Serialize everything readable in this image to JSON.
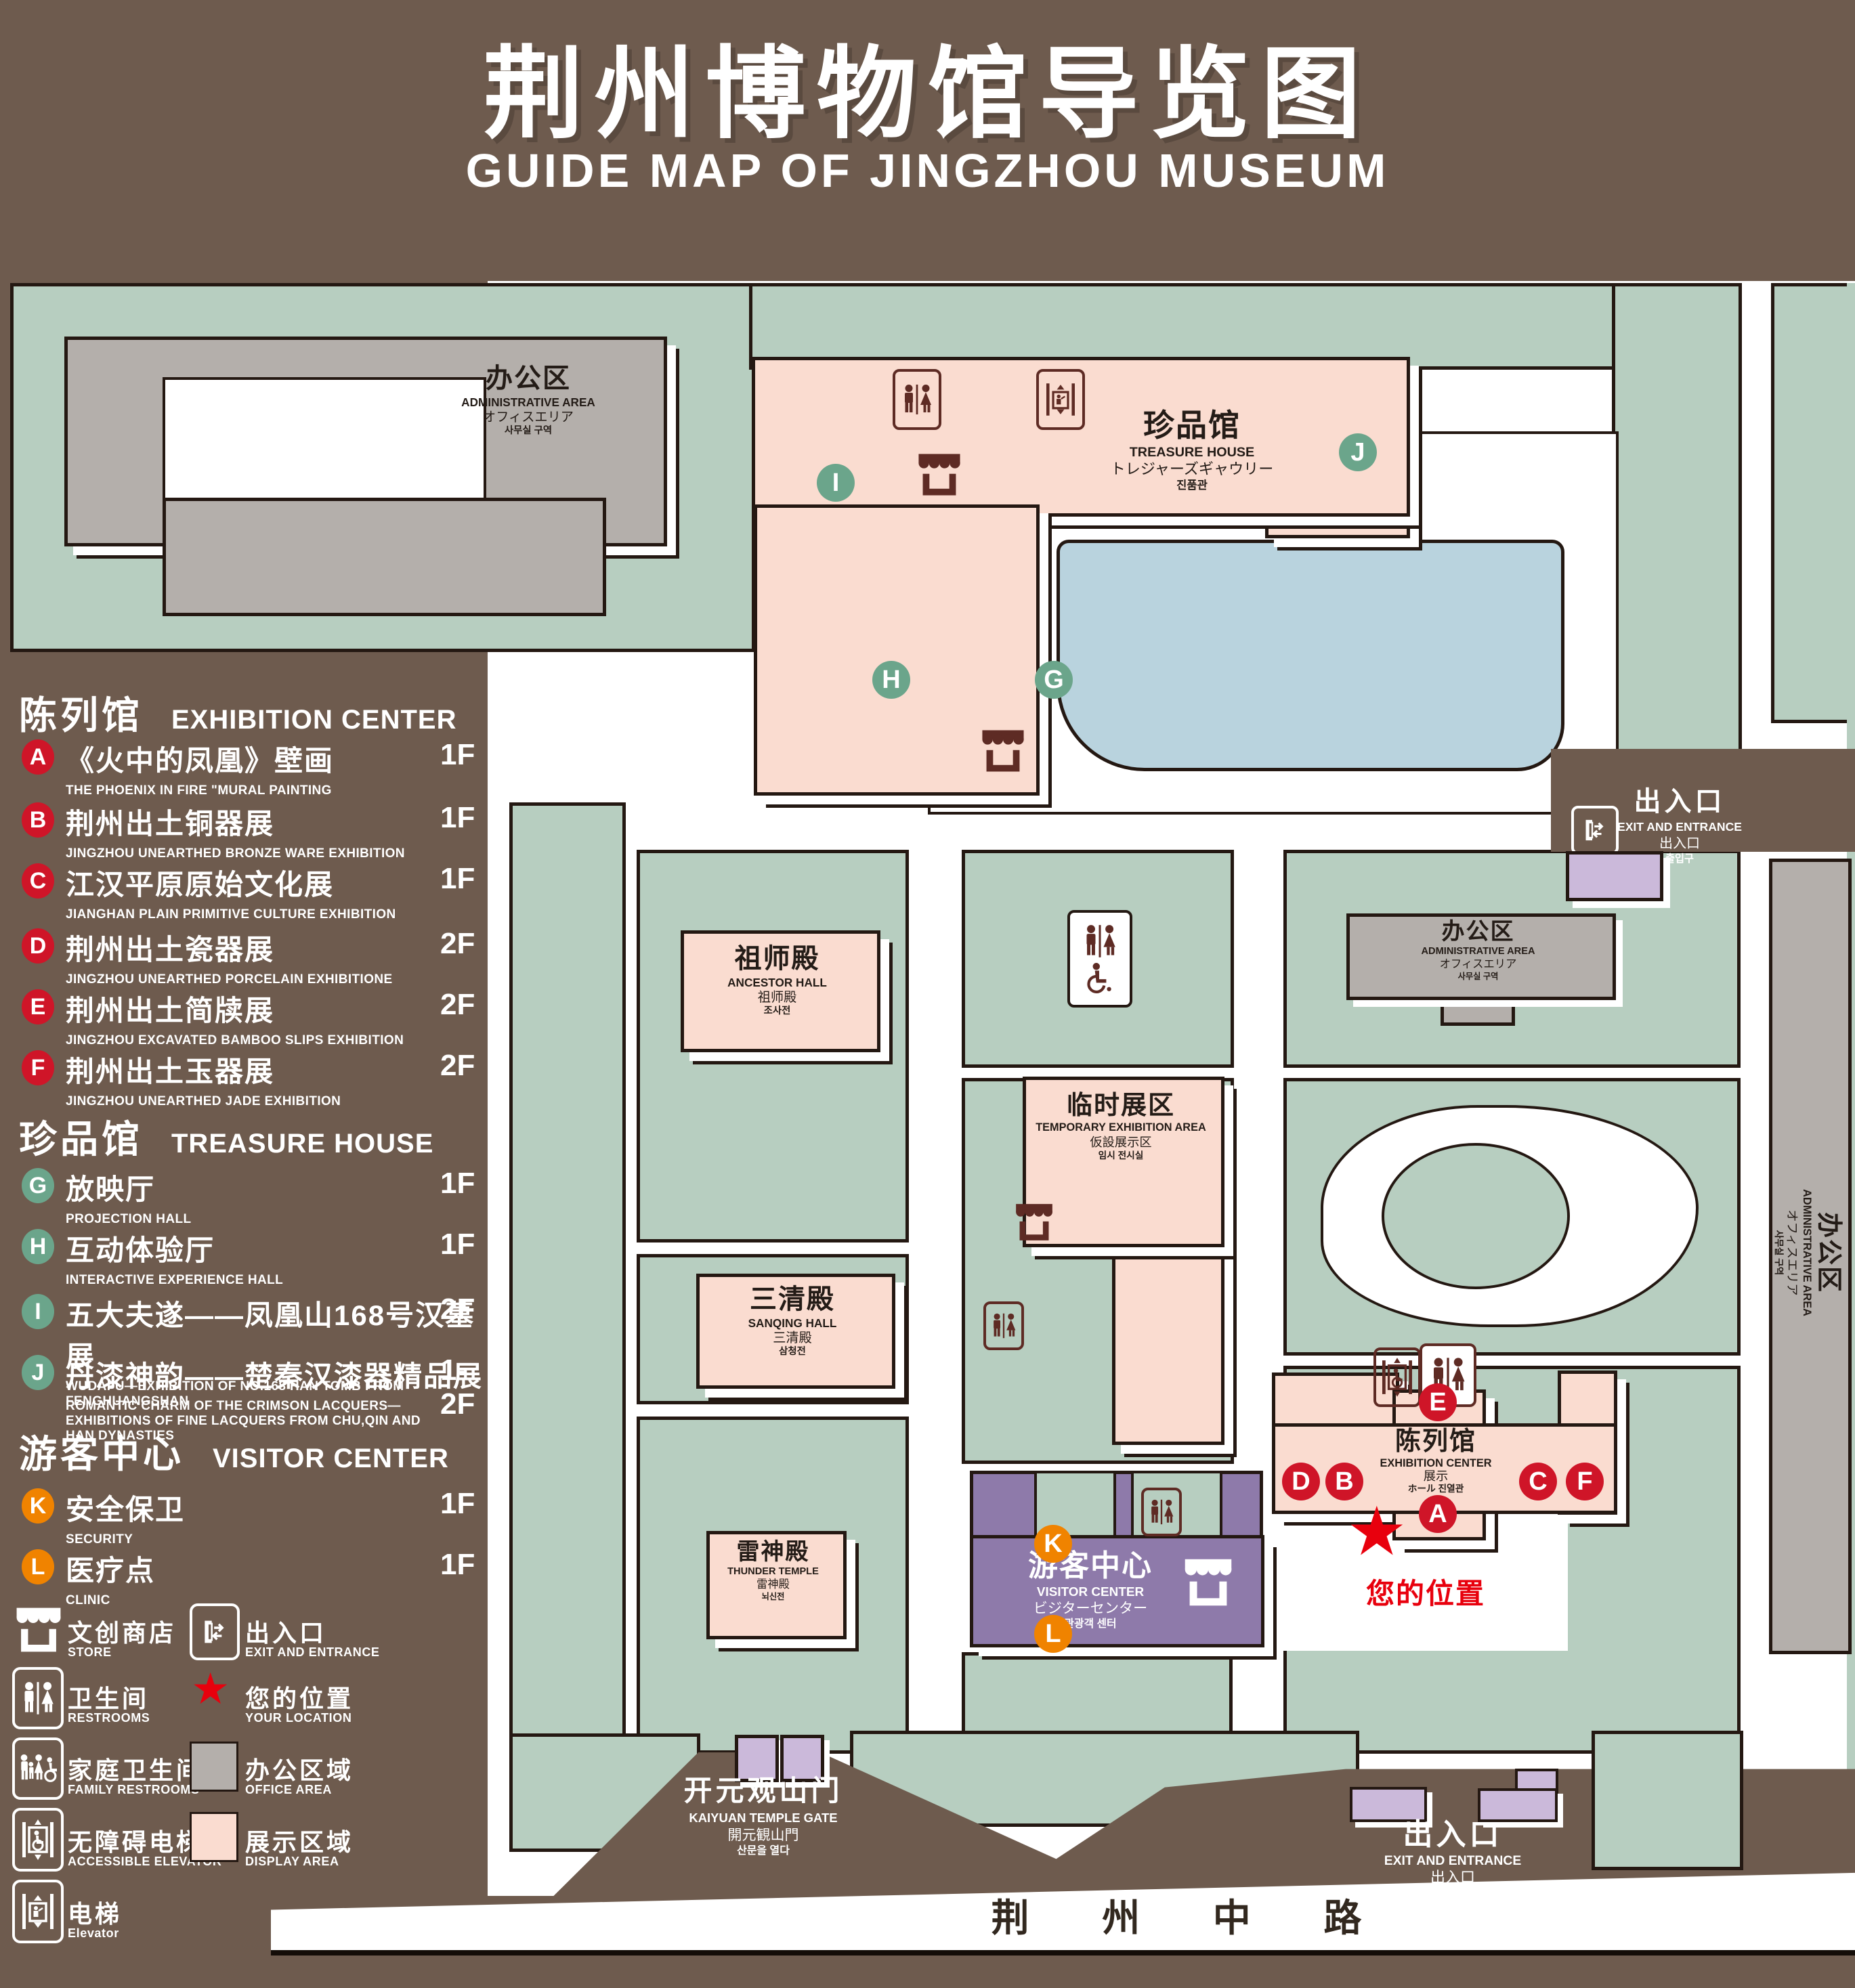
{
  "title": {
    "zh": "荆州博物馆导览图",
    "en": "GUIDE MAP OF JINGZHOU MUSEUM"
  },
  "colors": {
    "background": "#6e5b4e",
    "green_area": "#b7cec0",
    "display_area": "#fadcd0",
    "office_area": "#b4afab",
    "water": "#b9d3de",
    "visitor_center": "#8e7aaa",
    "gate_building": "#cbb9da",
    "marker_red": "#cf1528",
    "marker_green": "#6ba58b",
    "marker_orange": "#f08300",
    "location_red": "#e8000d",
    "icon_dark": "#5e2b24"
  },
  "legend": {
    "sections": [
      {
        "zh": "陈列馆",
        "en": "EXHIBITION CENTER"
      },
      {
        "zh": "珍品馆",
        "en": "TREASURE HOUSE"
      },
      {
        "zh": "游客中心",
        "en": "VISITOR CENTER"
      }
    ],
    "items": [
      {
        "code": "A",
        "zh": "《火中的凤凰》壁画",
        "en": "THE PHOENIX IN FIRE \"MURAL PAINTING",
        "floor": "1F"
      },
      {
        "code": "B",
        "zh": "荆州出土铜器展",
        "en": "JINGZHOU UNEARTHED BRONZE WARE EXHIBITION",
        "floor": "1F"
      },
      {
        "code": "C",
        "zh": "江汉平原原始文化展",
        "en": "JIANGHAN PLAIN PRIMITIVE CULTURE EXHIBITION",
        "floor": "1F"
      },
      {
        "code": "D",
        "zh": "荆州出土瓷器展",
        "en": "JINGZHOU UNEARTHED PORCELAIN EXHIBITIONE",
        "floor": "2F"
      },
      {
        "code": "E",
        "zh": "荆州出土简牍展",
        "en": "JINGZHOU EXCAVATED BAMBOO SLIPS EXHIBITION",
        "floor": "2F"
      },
      {
        "code": "F",
        "zh": "荆州出土玉器展",
        "en": "JINGZHOU UNEARTHED JADE EXHIBITION",
        "floor": "2F"
      },
      {
        "code": "G",
        "zh": "放映厅",
        "en": "PROJECTION HALL",
        "floor": "1F"
      },
      {
        "code": "H",
        "zh": "互动体验厅",
        "en": "INTERACTIVE EXPERIENCE HALL",
        "floor": "1F"
      },
      {
        "code": "I",
        "zh": "五大夫遂——凤凰山168号汉墓展",
        "en": "WUDAFU—EXHIBITION OF NO.168 HAN TOMB FROM FENGHUANGSHAN",
        "floor": "2F"
      },
      {
        "code": "J",
        "zh": "丹漆神韵——楚秦汉漆器精品展",
        "en": "ROMANTIC CHARM OF THE CRIMSON LACQUERS—EXHIBITIONS OF FINE LACQUERS FROM CHU,QIN AND HAN DYNASTIES",
        "floor": "1-2F"
      },
      {
        "code": "K",
        "zh": "安全保卫",
        "en": "SECURITY",
        "floor": "1F"
      },
      {
        "code": "L",
        "zh": "医疗点",
        "en": "CLINIC",
        "floor": "1F"
      }
    ],
    "symbols": [
      {
        "icon": "store-icon",
        "zh": "文创商店",
        "en": "STORE"
      },
      {
        "icon": "exit-icon",
        "zh": "出入口",
        "en": "EXIT AND ENTRANCE"
      },
      {
        "icon": "restroom-icon",
        "zh": "卫生间",
        "en": "RESTROOMS"
      },
      {
        "icon": "location-star-icon",
        "zh": "您的位置",
        "en": "YOUR LOCATION"
      },
      {
        "icon": "family-restroom-icon",
        "zh": "家庭卫生间",
        "en": "FAMILY RESTROOMS"
      },
      {
        "icon": "office-area-swatch",
        "zh": "办公区域",
        "en": "OFFICE AREA"
      },
      {
        "icon": "accessible-elevator-icon",
        "zh": "无障碍电梯",
        "en": "ACCESSIBLE ELEVATOR"
      },
      {
        "icon": "display-area-swatch",
        "zh": "展示区域",
        "en": "DISPLAY AREA"
      },
      {
        "icon": "elevator-icon",
        "zh": "电梯",
        "en": "Elevator"
      }
    ]
  },
  "map": {
    "buildings": {
      "admin": {
        "zh": "办公区",
        "en": "ADMINISTRATIVE AREA",
        "ja": "オフィスエリア",
        "ko": "사무실 구역"
      },
      "treasure": {
        "zh": "珍品馆",
        "en": "TREASURE HOUSE",
        "ja": "トレジャーズギャウリー",
        "ko": "진품관"
      },
      "ancestor": {
        "zh": "祖师殿",
        "en": "ANCESTOR HALL",
        "ja": "祖师殿",
        "ko": "조사전"
      },
      "temporary": {
        "zh": "临时展区",
        "en": "TEMPORARY EXHIBITION AREA",
        "ja": "仮設展示区",
        "ko": "임시 전시실"
      },
      "sanqing": {
        "zh": "三清殿",
        "en": "SANQING HALL",
        "ja": "三清殿",
        "ko": "삼청전"
      },
      "thunder": {
        "zh": "雷神殿",
        "en": "THUNDER TEMPLE",
        "ja": "雷神殿",
        "ko": "뇌신전"
      },
      "visitor": {
        "zh": "游客中心",
        "en": "VISITOR CENTER",
        "ja": "ビジターセンター",
        "ko": "관광객 센터"
      },
      "exhibition": {
        "zh": "陈列馆",
        "en": "EXHIBITION CENTER",
        "ja": "展示",
        "ko": "ホール 진열관"
      }
    },
    "exits": {
      "entrance": {
        "zh": "出入口",
        "en": "EXIT AND ENTRANCE",
        "ja": "出入口",
        "ko": "출입구"
      },
      "gate": {
        "zh": "开元观山门",
        "en": "KAIYUAN TEMPLE GATE",
        "ja": "開元観山門",
        "ko": "산문을 열다"
      }
    },
    "road": "荆 州 中 路",
    "your_location": "您的位置",
    "markers": [
      "A",
      "B",
      "C",
      "D",
      "E",
      "F",
      "G",
      "H",
      "I",
      "J",
      "K",
      "L"
    ]
  }
}
